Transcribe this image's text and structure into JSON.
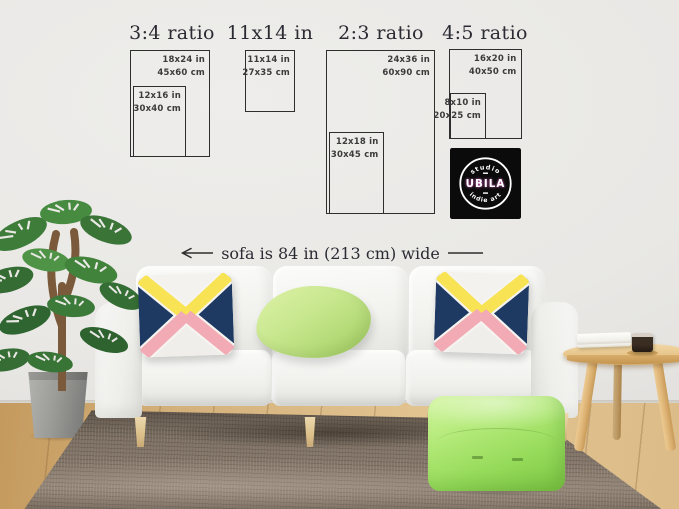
{
  "size_guide": {
    "groups": [
      {
        "title": "3:4 ratio",
        "outer": {
          "inches": "18x24 in",
          "cm": "45x60 cm"
        },
        "inner": {
          "inches": "12x16 in",
          "cm": "30x40 cm"
        }
      },
      {
        "title": "11x14 in",
        "outer": {
          "inches": "11x14 in",
          "cm": "27x35 cm"
        }
      },
      {
        "title": "2:3 ratio",
        "outer": {
          "inches": "24x36 in",
          "cm": "60x90 cm"
        },
        "inner": {
          "inches": "12x18 in",
          "cm": "30x45 cm"
        }
      },
      {
        "title": "4:5 ratio",
        "outer": {
          "inches": "16x20 in",
          "cm": "40x50 cm"
        },
        "inner": {
          "inches": "8x10 in",
          "cm": "20x25 cm"
        }
      }
    ]
  },
  "annotation": {
    "sofa_width": "sofa is 84 in (213 cm) wide"
  },
  "logo": {
    "top": "studio",
    "name": "UBILA",
    "bottom": "indie art"
  },
  "colors": {
    "line": "#2e2e2e",
    "title-text": "#2b2b33",
    "label-text": "#3b3b3b",
    "pillow-navy": "#1e3a63",
    "pillow-yellow": "#f7e354",
    "pillow-pink": "#f2abb5",
    "pillow-green": "#c3e388",
    "pouf-green": "#9bdf60",
    "logo-bg": "#0b0b0b",
    "logo-glow": "#f263d8",
    "wall": "#e9e8e5",
    "floor-wood": "#d8b683",
    "rug-brown": "#7e7165",
    "sofa-white": "#f4f4f1"
  }
}
